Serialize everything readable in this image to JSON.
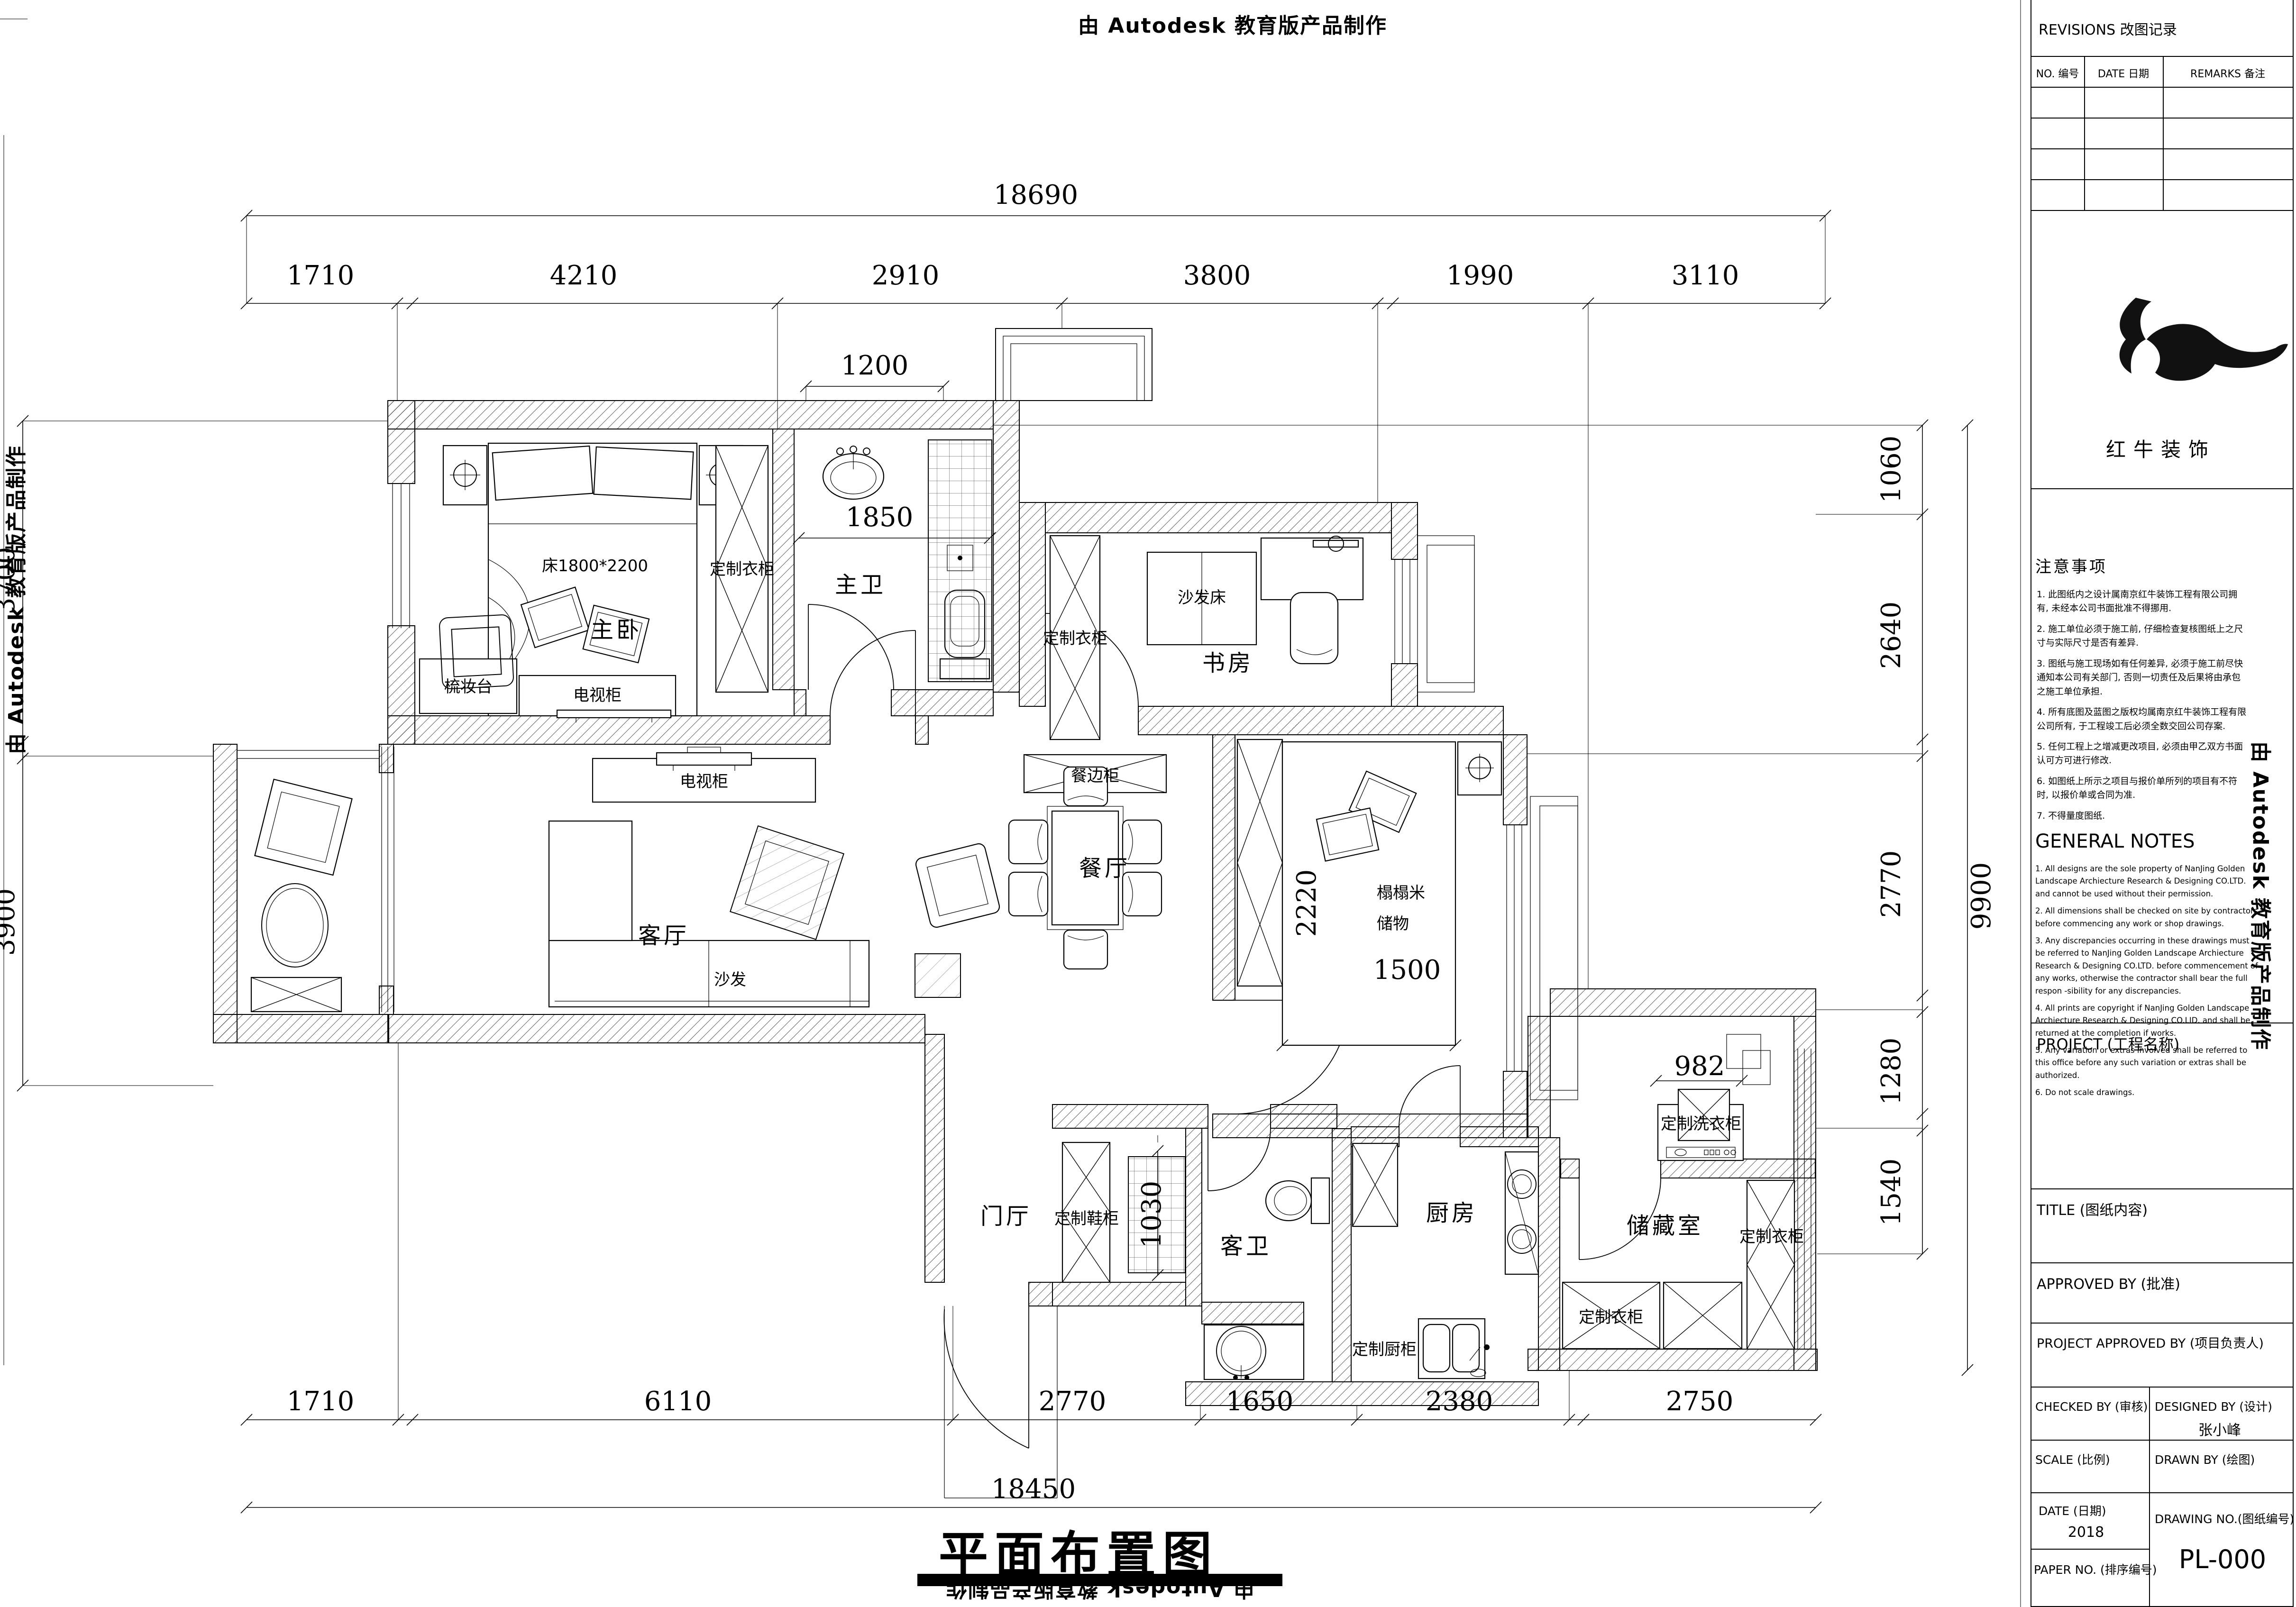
{
  "watermark": "由 Autodesk 教育版产品制作",
  "sheet_title": "平面布置图",
  "rooms": {
    "master_bedroom": "主卧",
    "master_bath": "主卫",
    "study": "书房",
    "living": "客厅",
    "dining": "餐厅",
    "guest_bath": "客卫",
    "kitchen": "厨房",
    "storage": "储藏室",
    "foyer": "门厅"
  },
  "furniture": {
    "bed_size": "床1800*2200",
    "wardrobe": "定制衣柜",
    "tv_cabinet": "电视柜",
    "dresser": "梳妆台",
    "sofa": "沙发",
    "sofa_bed": "沙发床",
    "sideboard": "餐边柜",
    "shoe_cabinet": "定制鞋柜",
    "kitchen_cabinet": "定制厨柜",
    "laundry_cabinet": "定制洗衣柜",
    "tatami_line1": "榻榻米",
    "tatami_line2": "储物"
  },
  "dims": {
    "top_total": "18690",
    "top": [
      "1710",
      "4210",
      "2910",
      "3800",
      "1990",
      "3110"
    ],
    "bottom": [
      "1710",
      "6110",
      "2770",
      "1650",
      "2380",
      "2750"
    ],
    "bottom_total": "18450",
    "left": [
      "3700",
      "3900"
    ],
    "right": [
      "1060",
      "2640",
      "2770",
      "1280",
      "1540"
    ],
    "right_total": "9900",
    "inner": {
      "bath_top": "1200",
      "bath": "1850",
      "tatami_h": "2220",
      "tatami_w": "1500",
      "laundry": "982",
      "foyer": "1030"
    }
  },
  "titleblock": {
    "revisions": "REVISIONS 改图记录",
    "col_no": "NO. 编号",
    "col_date": "DATE 日期",
    "col_remarks": "REMARKS 备注",
    "logo_name": "红牛装饰",
    "notes": {
      "title": "注意事项",
      "items": [
        "1.  此图纸内之设计属南京红牛装饰工程有限公司拥有, 未经本公司书面批准不得挪用.",
        "2.  施工单位必须于施工前, 仔细检查复核图纸上之尺寸与实际尺寸是否有差异.",
        "3.  图纸与施工现场如有任何差异, 必须于施工前尽快通知本公司有关部门, 否则一切责任及后果将由承包之施工单位承担.",
        "4.  所有底图及蓝图之版权均属南京红牛装饰工程有限公司所有, 于工程竣工后必须全数交回公司存案.",
        "5.  任何工程上之增减更改项目, 必须由甲乙双方书面认可方可进行修改.",
        "6.  如图纸上所示之项目与报价单所列的项目有不符时, 以报价单或合同为准.",
        "7.  不得量度图纸."
      ]
    },
    "general_notes": {
      "title": "GENERAL NOTES",
      "items": [
        "1. All designs are the sole property of NanJing Golden Landscape Archiecture Research & Designing CO.LTD. and cannot be used without their permission.",
        "2. All dimensions shall be checked on site by contractors before commencing any work or shop drawings.",
        "3. Any discrepancies occurring in these drawings must be referred to NanJing Golden Landscape Archiecture Research & Designing CO.LTD. before commencement of any works, otherwise the contractor shall bear the full respon -sibility for any discrepancies.",
        "4. All prints are copyright if NanJing Golden Landscape Archiecture Research & Designing CO.LID. and shall be returned at the completion if works.",
        "5. Any variation or extras involved shall be referred to this office before any such variation or extras shall be authorized.",
        "6. Do not scale drawings."
      ]
    },
    "project": "PROJECT (工程名称)",
    "title_row": "TITLE (图纸内容)",
    "approved": "APPROVED BY (批准)",
    "proj_approved": "PROJECT APPROVED BY (项目负责人)",
    "checked": "CHECKED BY (审核)",
    "designed": "DESIGNED BY (设计)",
    "designer_name": "张小峰",
    "scale": "SCALE (比例)",
    "drawn": "DRAWN BY (绘图)",
    "date": "DATE (日期)",
    "date_value": "2018",
    "drawing_no": "DRAWING NO.(图纸编号)",
    "drawing_no_value": "PL-000",
    "paper_no": "PAPER NO. (排序编号)"
  }
}
